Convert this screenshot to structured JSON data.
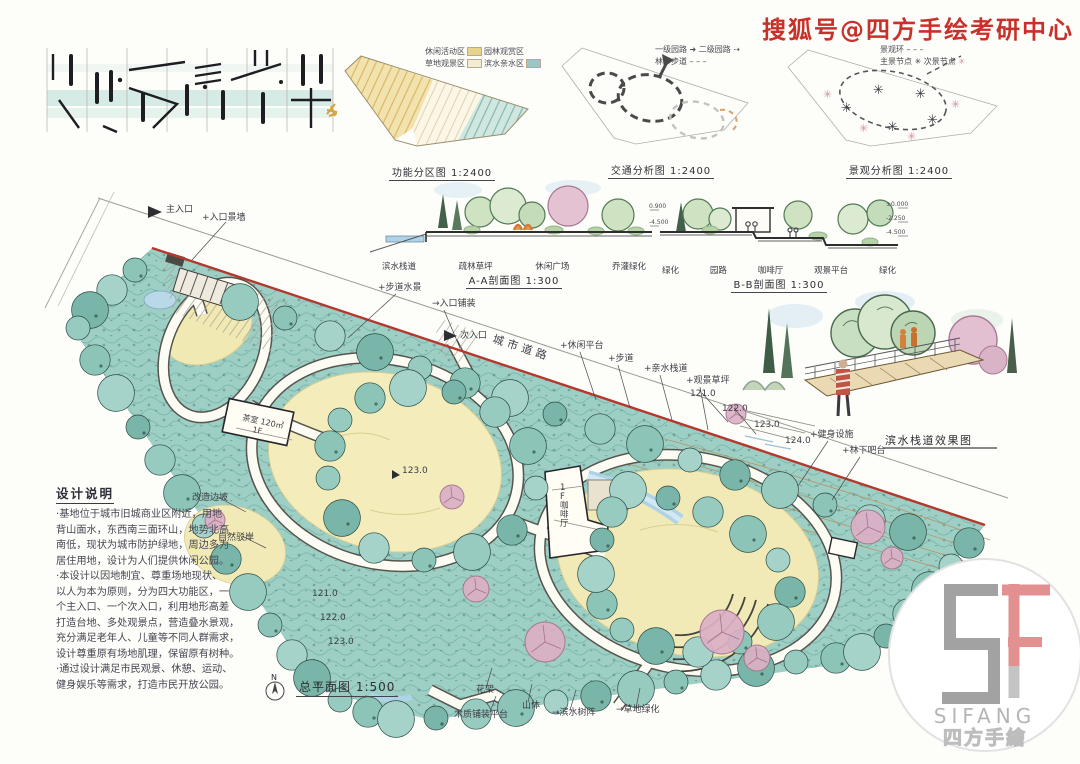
{
  "watermark": {
    "text": "搜狐号@四方手绘考研中心",
    "color": "#c9302a"
  },
  "diagrams": {
    "zoning": {
      "caption": "功能分区图 1:2400",
      "legend": [
        {
          "label": "休闲活动区",
          "color": "#e6d38c"
        },
        {
          "label": "园林观赏区",
          "color": "#f3ecd2"
        },
        {
          "label": "草地观景区",
          "color": "#fbf7e8"
        },
        {
          "label": "滨水亲水区",
          "color": "#97c9bf"
        }
      ]
    },
    "traffic": {
      "caption": "交通分析图 1:2400",
      "legend": [
        {
          "label": "一级园路"
        },
        {
          "label": "二级园路"
        },
        {
          "label": "林下步道"
        }
      ]
    },
    "landscape": {
      "caption": "景观分析图 1:2400",
      "legend": [
        {
          "label": "景观环"
        },
        {
          "label": "主景节点"
        },
        {
          "label": "次景节点"
        }
      ]
    },
    "section_a": {
      "caption": "A-A剖面图 1:300",
      "labels": [
        "滨水栈道",
        "疏林草坪",
        "休闲广场",
        "乔灌绿化"
      ]
    },
    "section_b": {
      "caption": "B-B剖面图 1:300",
      "labels": [
        "绿化",
        "园路",
        "咖啡厅",
        "观景平台",
        "绿化"
      ],
      "elev_left": [
        "0.900",
        "-4.500"
      ],
      "elev_right": [
        "±0.000",
        "-2.250",
        "-4.500"
      ]
    },
    "perspective": {
      "caption": "滨水栈道效果图"
    }
  },
  "plan": {
    "caption": "总平面图 1:500",
    "north": "N",
    "spot_elevation": "123.0",
    "annotations": [
      {
        "t": "主入口",
        "x": 126,
        "y": 22
      },
      {
        "t": "+入口景墙",
        "x": 162,
        "y": 30
      },
      {
        "t": "+步道水景",
        "x": 338,
        "y": 100
      },
      {
        "t": "→入口铺装",
        "x": 392,
        "y": 116
      },
      {
        "t": "次入口",
        "x": 420,
        "y": 148
      },
      {
        "t": "城市道路",
        "x": 452,
        "y": 152,
        "r": 18,
        "s": 11,
        "ls": 4
      },
      {
        "t": "+休闲平台",
        "x": 520,
        "y": 158
      },
      {
        "t": "+步道",
        "x": 568,
        "y": 171
      },
      {
        "t": "+亲水栈道",
        "x": 604,
        "y": 181
      },
      {
        "t": "+观景草坪",
        "x": 646,
        "y": 193
      },
      {
        "t": "121.0",
        "x": 650,
        "y": 206
      },
      {
        "t": "122.0",
        "x": 682,
        "y": 221
      },
      {
        "t": "123.0",
        "x": 714,
        "y": 237
      },
      {
        "t": "124.0",
        "x": 745,
        "y": 253
      },
      {
        "t": "+健身设施",
        "x": 770,
        "y": 247
      },
      {
        "t": "+林下吧台",
        "x": 802,
        "y": 263
      },
      {
        "t": "改造边坡",
        "x": 152,
        "y": 310
      },
      {
        "t": "自然驳岸",
        "x": 178,
        "y": 350
      },
      {
        "t": "121.0",
        "x": 272,
        "y": 406
      },
      {
        "t": "122.0",
        "x": 280,
        "y": 430
      },
      {
        "t": "123.0",
        "x": 288,
        "y": 454
      },
      {
        "t": "123.0",
        "x": 362,
        "y": 283
      },
      {
        "t": "花架",
        "x": 436,
        "y": 502
      },
      {
        "t": "木质铺装平台",
        "x": 414,
        "y": 527
      },
      {
        "t": "山体",
        "x": 482,
        "y": 518
      },
      {
        "t": "→滨水树阵",
        "x": 512,
        "y": 525
      },
      {
        "t": "→草地绿化",
        "x": 576,
        "y": 522
      },
      {
        "t": "茶室 120㎡",
        "x": 202,
        "y": 230,
        "r": 12,
        "s": 8
      },
      {
        "t": "1F",
        "x": 212,
        "y": 242,
        "r": 12,
        "s": 8
      },
      {
        "t": "1F咖啡厅",
        "x": 520,
        "y": 300,
        "vert": true,
        "s": 8.5
      }
    ]
  },
  "notes": {
    "title": "设计说明",
    "lines": [
      "·基地位于城市旧城商业区附近，用地",
      "背山面水，东西南三面环山，地势北高",
      "南低，现状为城市防护绿地，周边多为",
      "居住用地，设计为人们提供休闲公园。",
      "·本设计以因地制宜、尊重场地现状、",
      "以人为本为原则，分为四大功能区，一",
      "个主入口、一个次入口，利用地形高差",
      "打造台地、多处观景点，营造叠水景观，",
      "充分满足老年人、儿童等不同人群需求，",
      "设计尊重原有场地肌理，保留原有树种。",
      "·通过设计满足市民观景、休憩、运动、",
      "健身娱乐等需求，打造市民开放公园。"
    ]
  },
  "logo": {
    "en": "SIFANG",
    "cn": "四方手繪"
  }
}
